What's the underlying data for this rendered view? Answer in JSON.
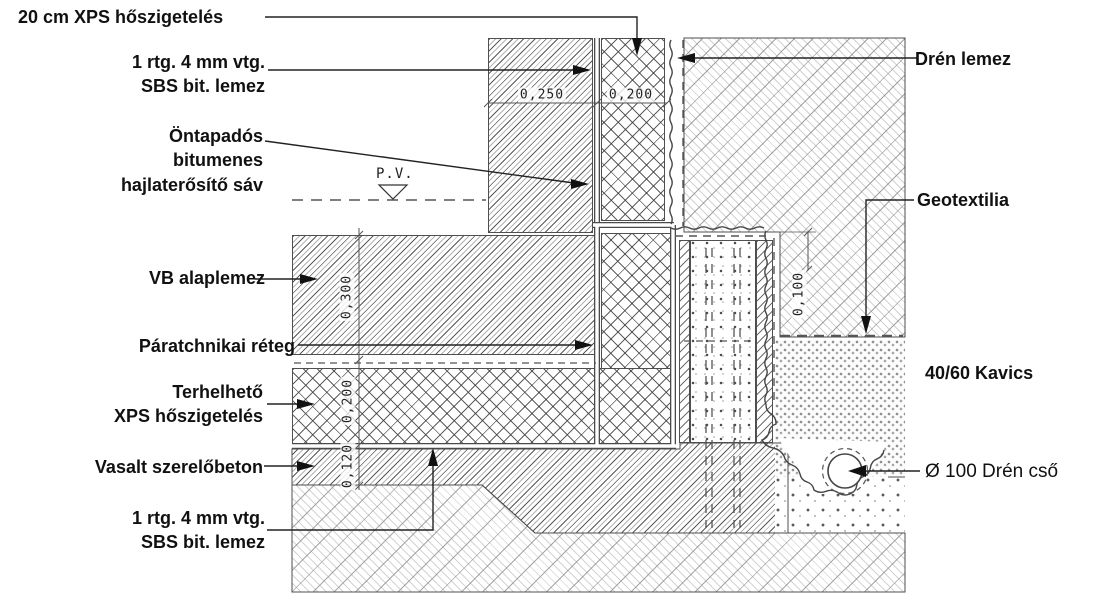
{
  "drawing": {
    "labels": {
      "xps_top": "20 cm XPS hőszigetelés",
      "sbs_top": "1 rtg. 4 mm vtg.\nSBS bit. lemez",
      "ontapados": "Öntapadós\nbitumenes\nhajlaterősítő sáv",
      "vb_alaplemez": "VB alaplemez",
      "paratechnikai": "Páratchnikai réteg",
      "terhelheto": "Terhelhető\nXPS hőszigetelés",
      "vasalt": "Vasalt szerelőbeton",
      "sbs_bottom": "1 rtg. 4 mm vtg.\nSBS bit. lemez",
      "dren_lemez": "Drén lemez",
      "geotextilia": "Geotextilia",
      "kavics": "40/60 Kavics",
      "dren_cso": "Ø 100 Drén cső",
      "pv": "P.V."
    },
    "dimensions": {
      "wall_width": "0,250",
      "wall_xps_width": "0,200",
      "slab_thickness": "0,300",
      "floor_xps_thickness": "0,200",
      "szerelobeton_thickness": "0,120",
      "dren_offset": "0,100"
    },
    "colors": {
      "line": "#3a3a3a",
      "label_text": "#111111",
      "dim_text": "#222222",
      "hatch_dark": "#4a4a4a",
      "hatch_light": "#bdbdbd",
      "background": "#ffffff"
    }
  }
}
